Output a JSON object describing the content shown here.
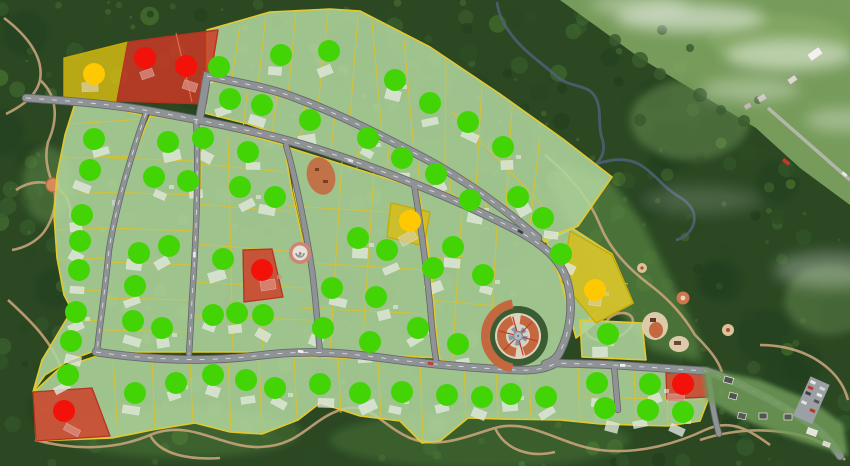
{
  "map": {
    "type": "residential-masterplan-aerial-view",
    "status_colors": {
      "green": "#43d405",
      "yellow": "#fec803",
      "red": "#f3120a"
    },
    "status_counts": {
      "green": 70,
      "yellow": 3,
      "red": 5,
      "total": 78
    },
    "palette": {
      "forest": "#2b4823",
      "field": "#7da35f",
      "lot_fill": "#afd49c",
      "lot_line": "#d9c22e",
      "red_lot": "#d03824",
      "yellow_lot": "#d8bd14",
      "road": "#8f9396",
      "road_edge": "#666a6d",
      "trail": "#cfa87e",
      "terracotta": "#c4693f",
      "stream": "#4e6178"
    },
    "dots": [
      {
        "x": 219,
        "y": 67,
        "c": "g"
      },
      {
        "x": 281,
        "y": 55,
        "c": "g"
      },
      {
        "x": 329,
        "y": 51,
        "c": "g"
      },
      {
        "x": 395,
        "y": 80,
        "c": "g"
      },
      {
        "x": 430,
        "y": 103,
        "c": "g"
      },
      {
        "x": 468,
        "y": 122,
        "c": "g"
      },
      {
        "x": 503,
        "y": 147,
        "c": "g"
      },
      {
        "x": 518,
        "y": 197,
        "c": "g"
      },
      {
        "x": 543,
        "y": 218,
        "c": "g"
      },
      {
        "x": 230,
        "y": 99,
        "c": "g"
      },
      {
        "x": 262,
        "y": 105,
        "c": "g"
      },
      {
        "x": 310,
        "y": 120,
        "c": "g"
      },
      {
        "x": 368,
        "y": 138,
        "c": "g"
      },
      {
        "x": 402,
        "y": 158,
        "c": "g"
      },
      {
        "x": 436,
        "y": 174,
        "c": "g"
      },
      {
        "x": 470,
        "y": 200,
        "c": "g"
      },
      {
        "x": 94,
        "y": 139,
        "c": "g"
      },
      {
        "x": 90,
        "y": 170,
        "c": "g"
      },
      {
        "x": 82,
        "y": 215,
        "c": "g"
      },
      {
        "x": 80,
        "y": 241,
        "c": "g"
      },
      {
        "x": 79,
        "y": 270,
        "c": "g"
      },
      {
        "x": 76,
        "y": 312,
        "c": "g"
      },
      {
        "x": 71,
        "y": 341,
        "c": "g"
      },
      {
        "x": 168,
        "y": 142,
        "c": "g"
      },
      {
        "x": 154,
        "y": 177,
        "c": "g"
      },
      {
        "x": 188,
        "y": 181,
        "c": "g"
      },
      {
        "x": 169,
        "y": 246,
        "c": "g"
      },
      {
        "x": 139,
        "y": 253,
        "c": "g"
      },
      {
        "x": 135,
        "y": 286,
        "c": "g"
      },
      {
        "x": 133,
        "y": 321,
        "c": "g"
      },
      {
        "x": 162,
        "y": 328,
        "c": "g"
      },
      {
        "x": 203,
        "y": 138,
        "c": "g"
      },
      {
        "x": 248,
        "y": 152,
        "c": "g"
      },
      {
        "x": 240,
        "y": 187,
        "c": "g"
      },
      {
        "x": 275,
        "y": 197,
        "c": "g"
      },
      {
        "x": 223,
        "y": 259,
        "c": "g"
      },
      {
        "x": 213,
        "y": 315,
        "c": "g"
      },
      {
        "x": 237,
        "y": 313,
        "c": "g"
      },
      {
        "x": 263,
        "y": 315,
        "c": "g"
      },
      {
        "x": 358,
        "y": 238,
        "c": "g"
      },
      {
        "x": 387,
        "y": 250,
        "c": "g"
      },
      {
        "x": 332,
        "y": 288,
        "c": "g"
      },
      {
        "x": 376,
        "y": 297,
        "c": "g"
      },
      {
        "x": 323,
        "y": 328,
        "c": "g"
      },
      {
        "x": 370,
        "y": 342,
        "c": "g"
      },
      {
        "x": 418,
        "y": 328,
        "c": "g"
      },
      {
        "x": 453,
        "y": 247,
        "c": "g"
      },
      {
        "x": 433,
        "y": 268,
        "c": "g"
      },
      {
        "x": 483,
        "y": 275,
        "c": "g"
      },
      {
        "x": 458,
        "y": 344,
        "c": "g"
      },
      {
        "x": 561,
        "y": 254,
        "c": "g"
      },
      {
        "x": 608,
        "y": 334,
        "c": "g"
      },
      {
        "x": 68,
        "y": 375,
        "c": "g"
      },
      {
        "x": 135,
        "y": 393,
        "c": "g"
      },
      {
        "x": 176,
        "y": 383,
        "c": "g"
      },
      {
        "x": 213,
        "y": 375,
        "c": "g"
      },
      {
        "x": 246,
        "y": 380,
        "c": "g"
      },
      {
        "x": 275,
        "y": 388,
        "c": "g"
      },
      {
        "x": 320,
        "y": 384,
        "c": "g"
      },
      {
        "x": 360,
        "y": 393,
        "c": "g"
      },
      {
        "x": 402,
        "y": 392,
        "c": "g"
      },
      {
        "x": 447,
        "y": 395,
        "c": "g"
      },
      {
        "x": 482,
        "y": 397,
        "c": "g"
      },
      {
        "x": 511,
        "y": 394,
        "c": "g"
      },
      {
        "x": 546,
        "y": 397,
        "c": "g"
      },
      {
        "x": 597,
        "y": 383,
        "c": "g"
      },
      {
        "x": 650,
        "y": 384,
        "c": "g"
      },
      {
        "x": 605,
        "y": 408,
        "c": "g"
      },
      {
        "x": 648,
        "y": 410,
        "c": "g"
      },
      {
        "x": 683,
        "y": 412,
        "c": "g"
      },
      {
        "x": 94,
        "y": 74,
        "c": "y"
      },
      {
        "x": 410,
        "y": 221,
        "c": "y"
      },
      {
        "x": 595,
        "y": 290,
        "c": "y"
      },
      {
        "x": 145,
        "y": 58,
        "c": "r"
      },
      {
        "x": 186,
        "y": 66,
        "c": "r"
      },
      {
        "x": 262,
        "y": 270,
        "c": "r"
      },
      {
        "x": 64,
        "y": 411,
        "c": "r"
      },
      {
        "x": 683,
        "y": 384,
        "c": "r"
      }
    ]
  }
}
